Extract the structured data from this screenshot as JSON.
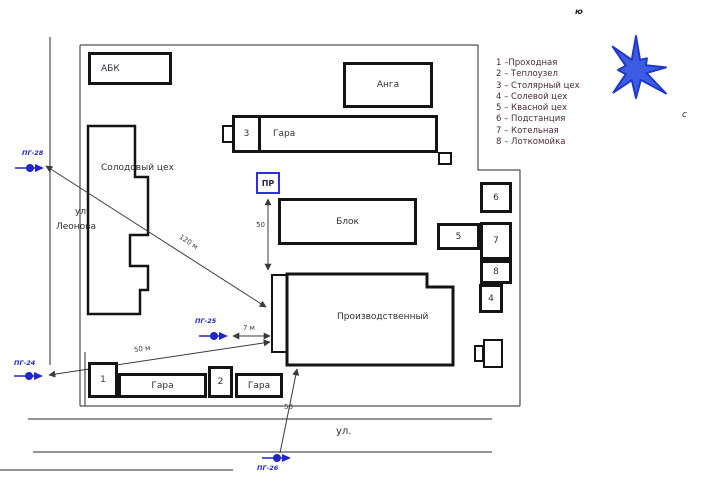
{
  "compass": {
    "south_label": "ю",
    "north_label": "с"
  },
  "legend": {
    "items": [
      "1 –Проходная",
      "2 – Теплоузел",
      "3 – Столярный цех",
      "4 – Солевой цех",
      "5 – Квасной цех",
      "6 – Подстанция",
      "7 – Котельная",
      "8 – Лоткомойка"
    ]
  },
  "streets": {
    "left_prefix": "ул.",
    "left_name": "Леонова",
    "bottom": "ул."
  },
  "buildings": {
    "abk": {
      "label": "АБК"
    },
    "anga": {
      "label": "Анга"
    },
    "gara_top": {
      "number": "3",
      "label": "Гара"
    },
    "solod": {
      "label": "Солодовый цех"
    },
    "blok": {
      "label": "Блок"
    },
    "proizv": {
      "label": "Производственный"
    },
    "b4": {
      "label": "4"
    },
    "b5": {
      "label": "5"
    },
    "b6": {
      "label": "6"
    },
    "b7": {
      "label": "7"
    },
    "b8": {
      "label": "8"
    },
    "garage1": {
      "number": "1",
      "label": "Гара"
    },
    "garage2": {
      "number": "2",
      "label": "Гара"
    }
  },
  "markers": {
    "pr": {
      "label": "ПР"
    },
    "pg28": {
      "label": "ПГ-28"
    },
    "pg25": {
      "label": "ПГ-25"
    },
    "pg24": {
      "label": "ПГ-24"
    },
    "pg26": {
      "label": "ПГ-26"
    }
  },
  "measurements": {
    "pg28_line": "120 м",
    "pr_line": "50",
    "pg25_line": "7 м",
    "pg24_line": "50 м",
    "pg26_line": "50"
  },
  "colors": {
    "accent_blue": "#2b3fd8",
    "star_fill": "#3c5ce6",
    "star_stroke": "#2038c8"
  }
}
